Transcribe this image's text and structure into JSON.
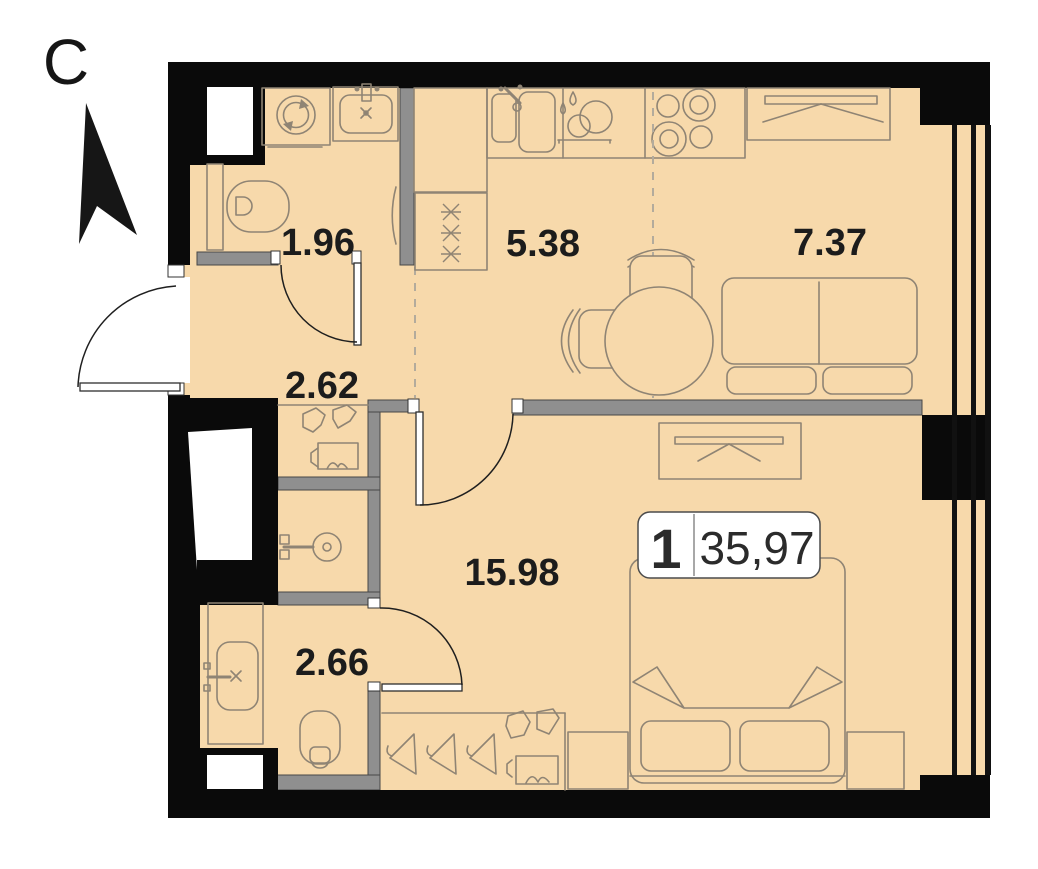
{
  "plan": {
    "north": {
      "letter": "С"
    },
    "badge": {
      "rooms_count": "1",
      "total_area": "35,97"
    },
    "rooms": [
      {
        "id": "bathroom-top",
        "area": "1.96"
      },
      {
        "id": "kitchen",
        "area": "5.38"
      },
      {
        "id": "living-room",
        "area": "7.37"
      },
      {
        "id": "hallway",
        "area": "2.62"
      },
      {
        "id": "bedroom",
        "area": "15.98"
      },
      {
        "id": "bathroom-bottom",
        "area": "2.66"
      }
    ],
    "colors": {
      "floor": "#f7d9ab",
      "exterior_walls": "#0a0a0a",
      "partitions": "#8f8f8f",
      "fixture_lines": "#8f8474",
      "label_text": "#1c1c1c",
      "badge_background": "#ffffff"
    },
    "icons": [
      "north-arrow-icon",
      "washing-machine-icon",
      "bathroom-sink-icon",
      "toilet-icon",
      "kitchen-double-sink-icon",
      "dish-rack-icon",
      "stove-icon",
      "fridge-icon",
      "wardrobe-icon",
      "sofa-icon",
      "dining-table-icon",
      "chair-icon",
      "bed-icon",
      "nightstand-icon",
      "hanger-icon",
      "shoe-box-icon",
      "shower-icon",
      "vanity-sink-icon"
    ]
  }
}
